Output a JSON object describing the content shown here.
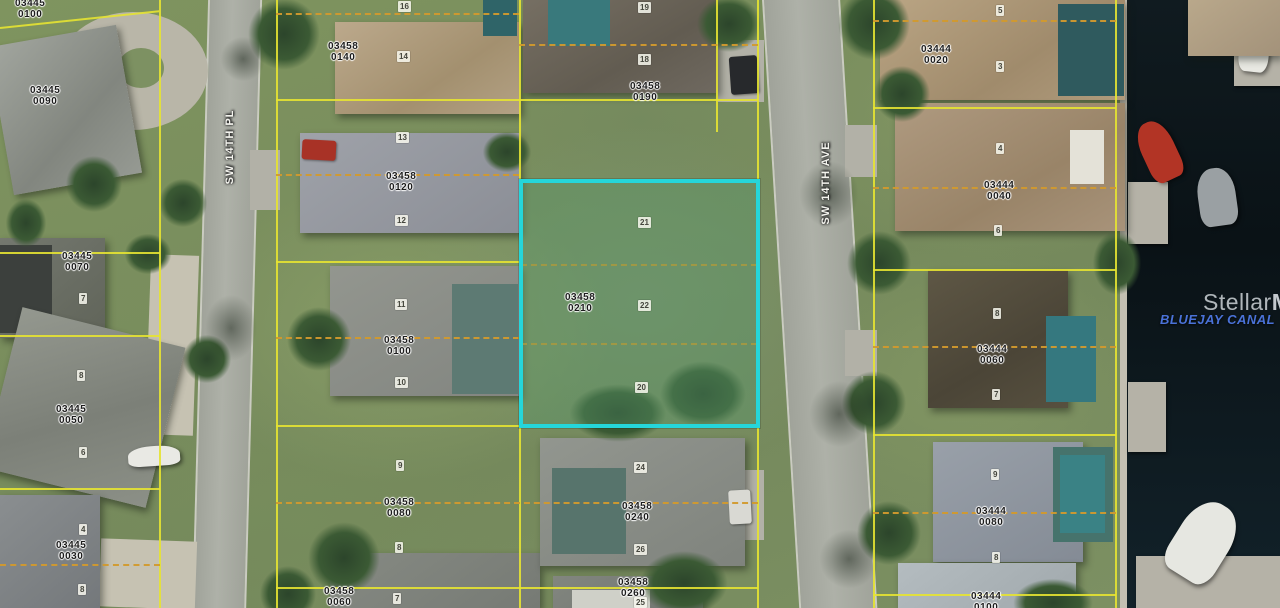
{
  "map": {
    "type": "aerial-parcel-map",
    "labels": {
      "street_pl": "SW 14TH PL",
      "street_ave": "SW 14TH AVE",
      "canal": "BLUEJAY CANAL",
      "watermark_a": "Stellar",
      "watermark_b": "MLS"
    },
    "highlighted_parcel": {
      "id": "03458 0210",
      "lot_numbers": [
        "21",
        "22",
        "20"
      ],
      "border_color": "#25d6da"
    },
    "colors": {
      "parcel_line": "#e6e332",
      "lot_split_line": "#d29a2e",
      "water": "#0d171c",
      "street": "#a8aba1",
      "canal_label": "#4a72d8",
      "watermark": "#cdd2d7"
    }
  },
  "parcel_labels": [
    {
      "id": "03445\n0100",
      "x": 15,
      "y": -2
    },
    {
      "id": "03445\n0090",
      "x": 30,
      "y": 85
    },
    {
      "id": "03445\n0070",
      "x": 62,
      "y": 251
    },
    {
      "id": "03445\n0050",
      "x": 56,
      "y": 404
    },
    {
      "id": "03445\n0030",
      "x": 56,
      "y": 540
    },
    {
      "id": "03458\n0140",
      "x": 328,
      "y": 41
    },
    {
      "id": "03458\n0120",
      "x": 386,
      "y": 171
    },
    {
      "id": "03458\n0100",
      "x": 384,
      "y": 335
    },
    {
      "id": "03458\n0080",
      "x": 384,
      "y": 497
    },
    {
      "id": "03458\n0060",
      "x": 324,
      "y": 586
    },
    {
      "id": "03458\n0190",
      "x": 630,
      "y": 81
    },
    {
      "id": "03458\n0210",
      "x": 565,
      "y": 292
    },
    {
      "id": "03458\n0240",
      "x": 622,
      "y": 501
    },
    {
      "id": "03458\n0260",
      "x": 618,
      "y": 577
    },
    {
      "id": "03444\n0020",
      "x": 921,
      "y": 44
    },
    {
      "id": "03444\n0040",
      "x": 984,
      "y": 180
    },
    {
      "id": "03444\n0060",
      "x": 977,
      "y": 344
    },
    {
      "id": "03444\n0080",
      "x": 976,
      "y": 506
    },
    {
      "id": "03444\n0100",
      "x": 971,
      "y": 591
    }
  ],
  "lot_badges": [
    {
      "n": "16",
      "x": 398,
      "y": 1
    },
    {
      "n": "14",
      "x": 397,
      "y": 51
    },
    {
      "n": "13",
      "x": 396,
      "y": 132
    },
    {
      "n": "12",
      "x": 395,
      "y": 215
    },
    {
      "n": "11",
      "x": 395,
      "y": 299
    },
    {
      "n": "10",
      "x": 395,
      "y": 377
    },
    {
      "n": "9",
      "x": 396,
      "y": 460
    },
    {
      "n": "8",
      "x": 395,
      "y": 542
    },
    {
      "n": "7",
      "x": 393,
      "y": 593
    },
    {
      "n": "19",
      "x": 638,
      "y": 2
    },
    {
      "n": "18",
      "x": 638,
      "y": 54
    },
    {
      "n": "21",
      "x": 638,
      "y": 217
    },
    {
      "n": "22",
      "x": 638,
      "y": 300
    },
    {
      "n": "20",
      "x": 635,
      "y": 382
    },
    {
      "n": "24",
      "x": 634,
      "y": 462
    },
    {
      "n": "26",
      "x": 634,
      "y": 544
    },
    {
      "n": "25",
      "x": 634,
      "y": 597
    },
    {
      "n": "5",
      "x": 996,
      "y": 5
    },
    {
      "n": "3",
      "x": 996,
      "y": 61
    },
    {
      "n": "4",
      "x": 996,
      "y": 143
    },
    {
      "n": "6",
      "x": 994,
      "y": 225
    },
    {
      "n": "8",
      "x": 993,
      "y": 308
    },
    {
      "n": "7",
      "x": 992,
      "y": 389
    },
    {
      "n": "9",
      "x": 991,
      "y": 469
    },
    {
      "n": "8",
      "x": 992,
      "y": 552
    },
    {
      "n": "7",
      "x": 79,
      "y": 293
    },
    {
      "n": "8",
      "x": 77,
      "y": 370
    },
    {
      "n": "6",
      "x": 79,
      "y": 447
    },
    {
      "n": "4",
      "x": 79,
      "y": 524
    },
    {
      "n": "8",
      "x": 78,
      "y": 584
    }
  ]
}
